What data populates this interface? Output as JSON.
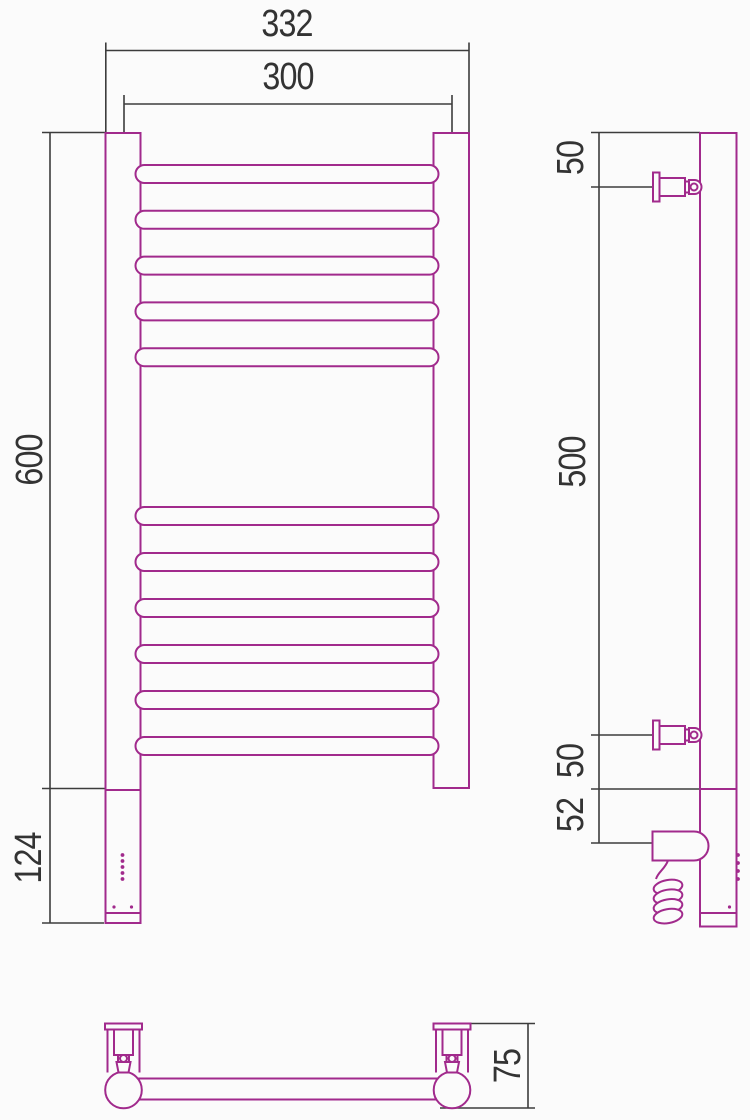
{
  "drawing": {
    "kind": "technical-dimension-drawing",
    "subject": "ladder-style heated towel rail with electric heating element, three orthographic views",
    "colors": {
      "product_line": "#A12A8C",
      "dimension_line": "#3C3C3C",
      "background": "#FBFBFB",
      "text": "#333333"
    },
    "front_view": {
      "rung_count_top_group": 5,
      "rung_count_bottom_group": 6,
      "element_indicator_dot_count": 5,
      "element_screw_dot_count": 2
    },
    "side_view": {
      "bracket_count": 2,
      "edge_tick_count": 4,
      "cable_coil_loop_count": 4
    },
    "bottom_view": {
      "bracket_count": 2
    }
  },
  "labels": {
    "overall_width": "332",
    "center_spacing": "300",
    "height": "600",
    "lower_section_height": "124",
    "side_top_offset": "50",
    "side_bracket_spacing": "500",
    "side_bottom_offset": "50",
    "side_element_height": "52",
    "bottom_depth": "75"
  }
}
